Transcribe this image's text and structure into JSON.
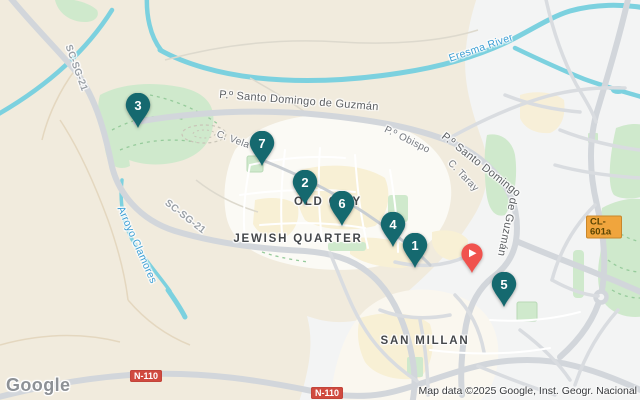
{
  "map": {
    "labels": {
      "santo_domingo_top": "P.º Santo Domingo de Guzmán",
      "santo_domingo_right_1": "P.º Santo Domingo",
      "santo_domingo_right_2": "de Guzmán",
      "eresma_river": "Eresma River",
      "arroyo_clamores": "Arroyo Clamores",
      "sc_sg_21_a": "SC-SG-21",
      "sc_sg_21_b": "SC-SG-21",
      "c_vela": "C. Vela",
      "p_obispo": "P.º Obispo",
      "c_taray": "C. Taray",
      "old_city": "OLD CITY",
      "jewish_quarter": "JEWISH QUARTER",
      "san_millan": "SAN MILLAN"
    },
    "road_badges": {
      "n110_a": "N-110",
      "n110_b": "N-110",
      "cl601a": "CL-601a"
    },
    "markers": [
      {
        "number": "1",
        "x": 415,
        "y": 245
      },
      {
        "number": "2",
        "x": 305,
        "y": 182
      },
      {
        "number": "3",
        "x": 138,
        "y": 105
      },
      {
        "number": "4",
        "x": 393,
        "y": 224
      },
      {
        "number": "5",
        "x": 504,
        "y": 284
      },
      {
        "number": "6",
        "x": 342,
        "y": 203
      },
      {
        "number": "7",
        "x": 262,
        "y": 143
      }
    ],
    "featured_marker": {
      "icon": "play-icon",
      "x": 472,
      "y": 253
    },
    "colors": {
      "marker": "#15696F",
      "featured_marker": "#F0534E",
      "water": "#7CD1DF",
      "park": "#CFE9CC",
      "road_major": "#D2D6DB",
      "badge_red": "#D04A3F",
      "badge_amber": "#F0A53D",
      "water_label": "#3D9FD4",
      "area_label": "#45484B"
    }
  },
  "attribution": {
    "google_logo": "Google",
    "map_data": "Map data ©2025 Google, Inst. Geogr. Nacional"
  }
}
